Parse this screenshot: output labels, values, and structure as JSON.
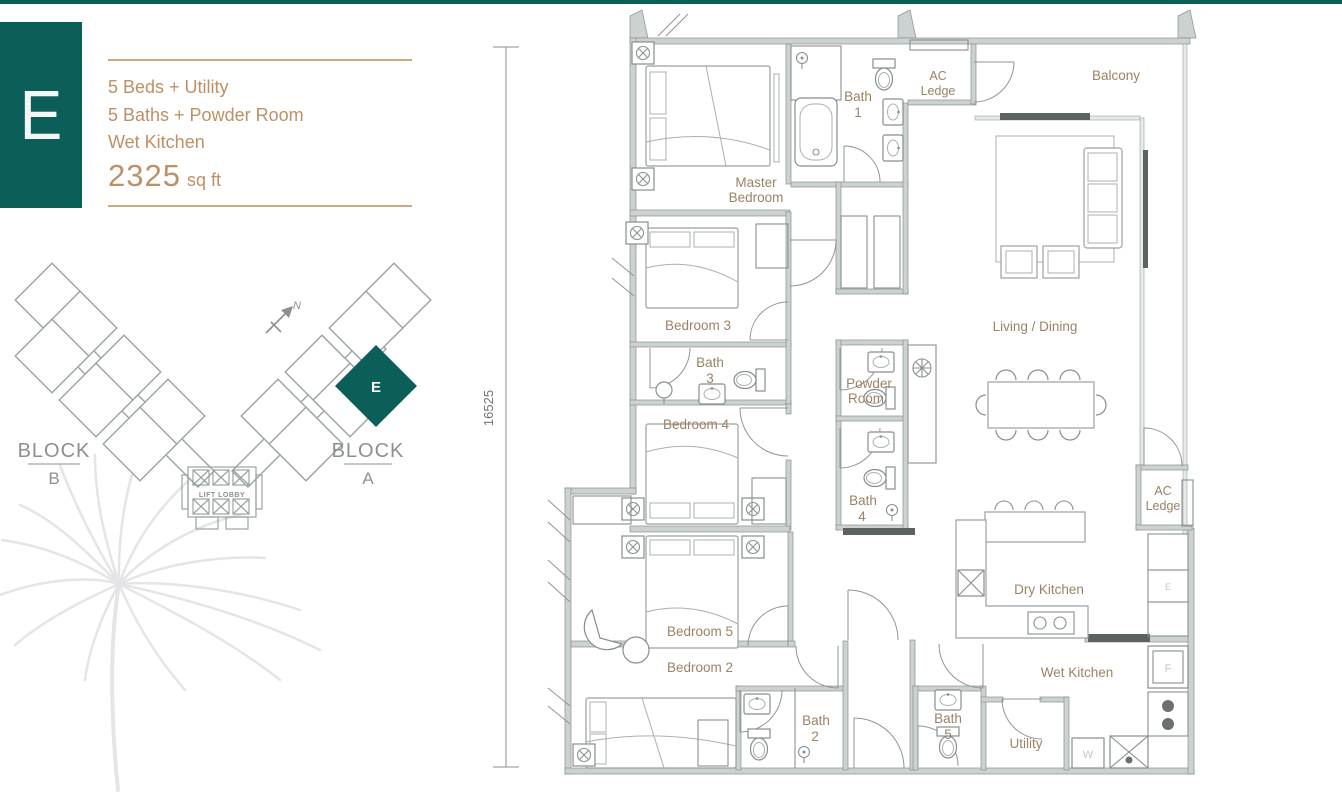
{
  "colors": {
    "accent_teal": "#0b5f58",
    "header_tan": "#bd9065",
    "divider_tan": "#cfa87b",
    "room_label_brown": "#9b8266",
    "plan_gray": "#8a9090",
    "block_label_gray": "#8b9191",
    "watermark_gray": "#e6e6e9"
  },
  "header": {
    "unit_letter": "E",
    "features": [
      "5 Beds + Utility",
      "5 Baths + Powder Room",
      "Wet Kitchen"
    ],
    "area_value": "2325",
    "area_unit": "sq ft"
  },
  "key_plan": {
    "block_left": {
      "word": "BLOCK",
      "letter": "B"
    },
    "block_right": {
      "word": "BLOCK",
      "letter": "A"
    },
    "lift_lobby": "LIFT LOBBY",
    "unit_marker": "E",
    "north_letter": "N"
  },
  "dimension": {
    "left_height": "16525"
  },
  "plan": {
    "rooms": {
      "master_bedroom": {
        "line1": "Master",
        "line2": "Bedroom"
      },
      "bath1": {
        "line1": "Bath",
        "line2": "1"
      },
      "ac_ledge_top": {
        "line1": "AC",
        "line2": "Ledge"
      },
      "balcony": "Balcony",
      "living_dining": "Living / Dining",
      "bedroom3": "Bedroom 3",
      "bath3": {
        "line1": "Bath",
        "line2": "3"
      },
      "bedroom4": "Bedroom 4",
      "powder_room": {
        "line1": "Powder",
        "line2": "Room"
      },
      "bath4": {
        "line1": "Bath",
        "line2": "4"
      },
      "bedroom5": "Bedroom 5",
      "bedroom2": "Bedroom 2",
      "bath2": {
        "line1": "Bath",
        "line2": "2"
      },
      "bath5": {
        "line1": "Bath",
        "line2": "5"
      },
      "utility": "Utility",
      "wet_kitchen": "Wet Kitchen",
      "dry_kitchen": "Dry Kitchen",
      "ac_ledge_right": {
        "line1": "AC",
        "line2": "Ledge"
      }
    },
    "appliances": {
      "cabinet_e": "E",
      "fridge_f": "F",
      "washer_w": "W"
    }
  }
}
